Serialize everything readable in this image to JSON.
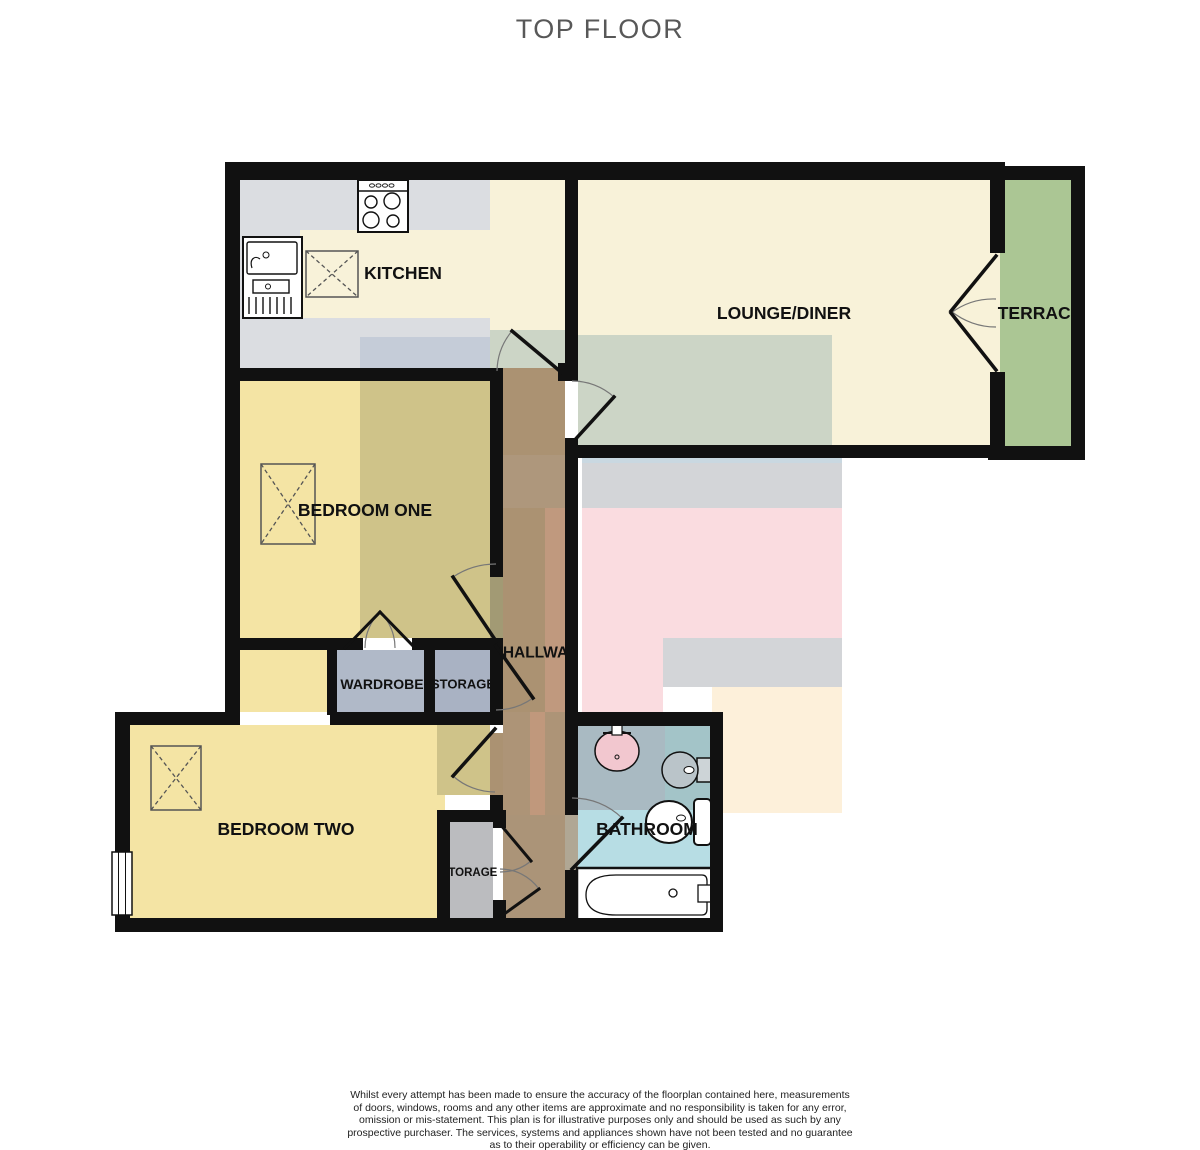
{
  "title": "TOP FLOOR",
  "palette": {
    "wall": "#111111",
    "title-gray": "#585858",
    "cream": "#f8f2d9",
    "counter-gray": "#dbdde1",
    "counter-blue": "#c5ccd8",
    "sage": "#ccd5c6",
    "terrace-green": "#abc694",
    "yellow": "#f4e4a4",
    "olive": "#cfc389",
    "hall-brown": "#ab9272",
    "hall-salmon": "#c0997e",
    "closet-blue": "#b0b9c8",
    "storage-gray": "#bbbcbf",
    "bath-blue": "#b7dde4",
    "bath-gray": "#a9bac2",
    "bath-teal": "#a3c4c8",
    "ghost-gray": "#d3d5d8",
    "ghost-pink": "#fadce0",
    "ghost-cream": "#fdf0da",
    "basin-pink": "#f2c7cf"
  },
  "rooms": {
    "kitchen": {
      "label": "KITCHEN"
    },
    "lounge_diner": {
      "label": "LOUNGE/DINER"
    },
    "terrace": {
      "label": "TERRACE"
    },
    "bedroom_one": {
      "label": "BEDROOM ONE"
    },
    "hallway": {
      "label": "HALLWAY"
    },
    "wardrobe": {
      "label": "WARDROBE"
    },
    "storage_upper": {
      "label": "STORAGE"
    },
    "bedroom_two": {
      "label": "BEDROOM TWO"
    },
    "bathroom": {
      "label": "BATHROOM"
    },
    "storage_lower": {
      "label": "STORAGE"
    }
  },
  "footer": {
    "disclaimer_lines": [
      "Whilst every attempt has been made to ensure the accuracy of the floorplan contained here, measurements",
      "of doors, windows, rooms and any other items are approximate and no responsibility is taken for any error,",
      "omission or mis-statement. This plan is for illustrative purposes only and should be used as such by any",
      "prospective purchaser. The services, systems and appliances shown have not been tested and no guarantee",
      "as to their operability or efficiency can be given."
    ],
    "credit": "Made with Metropix ©2024"
  }
}
